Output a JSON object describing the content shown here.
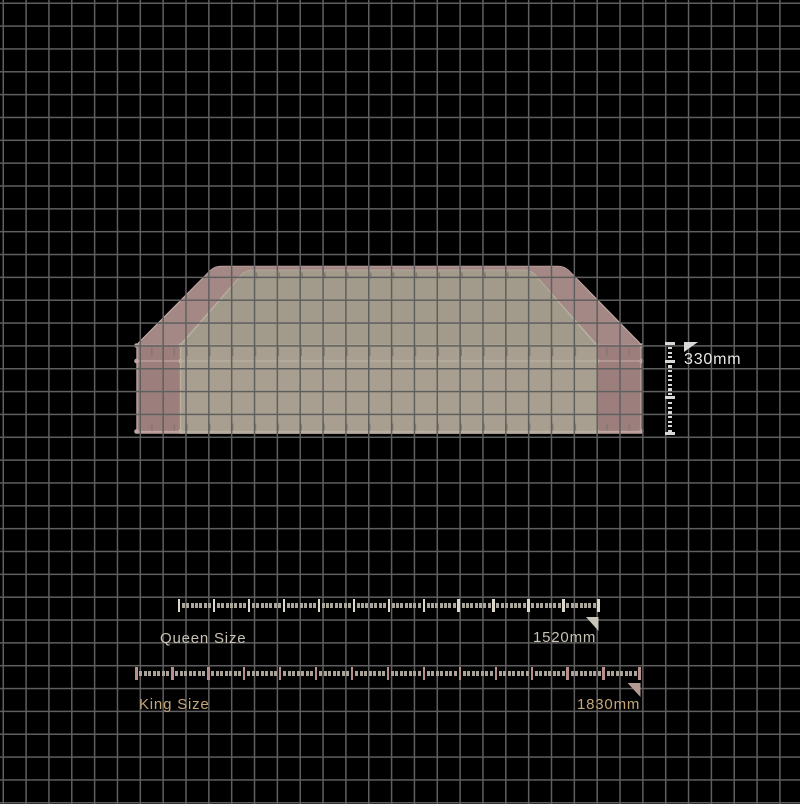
{
  "diagram": {
    "annotations": {
      "height": {
        "label": "330mm"
      },
      "queen": {
        "name": "Queen Size",
        "width": "1520mm"
      },
      "king": {
        "name": "King Size",
        "width": "1830mm"
      }
    },
    "colors": {
      "background": "#000000",
      "grid_line": "#5f5f5f",
      "king_fill": "#9c7f7c",
      "king_top_fill": "#a38885",
      "king_piping": "#bfa49f",
      "king_stitch": "#8d7672",
      "queen_fill": "#a89f90",
      "queen_top_fill": "#a29a8a",
      "queen_piping": "#b9b0a0",
      "queen_stitch": "#837b6f",
      "height_ruler_tick": "#d8d7d3",
      "height_flag": "#d9d9d6",
      "height_text": "#e8e7e3",
      "queen_tick_major": "#dcd7c6",
      "queen_tick_minor": "#aaa69c",
      "queen_flag": "#c9c4b8",
      "queen_text": "#c8c2b4",
      "king_tick_major": "#b98f8d",
      "king_tick_minor": "#a9a39a",
      "king_flag": "#b59a94",
      "king_text": "#c5a678"
    }
  }
}
